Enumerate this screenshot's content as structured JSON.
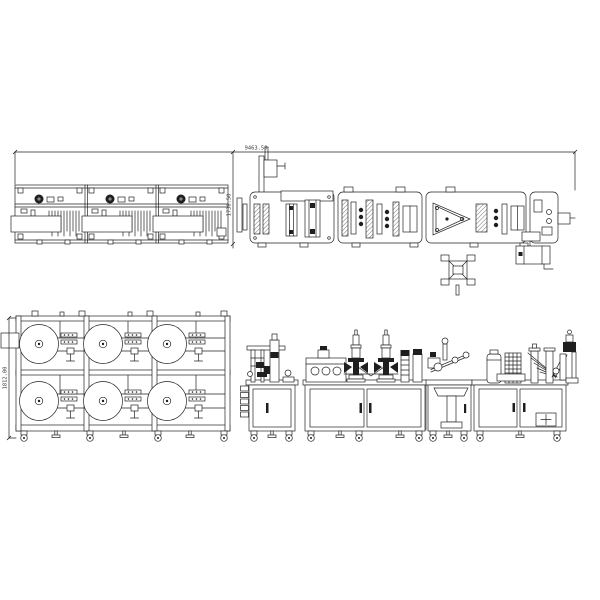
{
  "canvas": {
    "background": "#ffffff",
    "line_color": "#232323",
    "dark_fill": "#1f1f1f"
  },
  "drawing": {
    "dimensions": {
      "overall_length": "9463.50",
      "machine_depth": "1738.50",
      "stand_height": "1812.00"
    },
    "views": {
      "plan_roll_stand": {
        "module_count": 3
      },
      "plan_machine": {
        "section_count": 4
      },
      "front_roll_stand": {
        "rolls": [
          {
            "cx": 39,
            "cy": 344,
            "r": 19
          },
          {
            "cx": 103,
            "cy": 344,
            "r": 19
          },
          {
            "cx": 167,
            "cy": 344,
            "r": 19
          },
          {
            "cx": 39,
            "cy": 401,
            "r": 20
          },
          {
            "cx": 103,
            "cy": 401,
            "r": 20
          },
          {
            "cx": 167,
            "cy": 401,
            "r": 20
          }
        ]
      },
      "front_machine": {
        "cabinet_count": 4,
        "welding_towers": [
          {
            "x": 356,
            "y": 382
          },
          {
            "x": 386,
            "y": 382
          }
        ]
      }
    }
  }
}
